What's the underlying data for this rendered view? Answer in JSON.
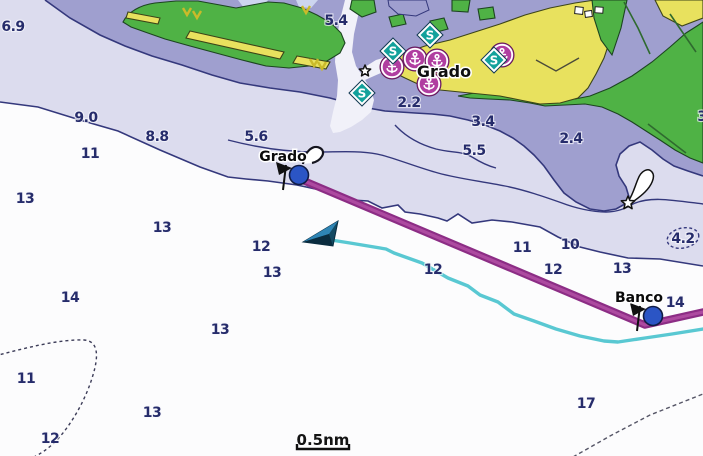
{
  "chart": {
    "type": "nautical-chartplotter-map",
    "scale_bar": {
      "label": "0.5nm",
      "x": 323,
      "y": 440,
      "bar_x1": 297,
      "bar_x2": 349,
      "bar_y": 449
    },
    "town_labels": [
      {
        "t": "Grado",
        "x": 444,
        "y": 71
      }
    ],
    "depth_labels": [
      {
        "t": "6.9",
        "x": 13,
        "y": 26
      },
      {
        "t": "5.4",
        "x": 336,
        "y": 20
      },
      {
        "t": "9.0",
        "x": 86,
        "y": 117
      },
      {
        "t": "8.8",
        "x": 157,
        "y": 136
      },
      {
        "t": "11",
        "x": 90,
        "y": 153
      },
      {
        "t": "5.6",
        "x": 256,
        "y": 136
      },
      {
        "t": "2.2",
        "x": 409,
        "y": 102
      },
      {
        "t": "3.4",
        "x": 483,
        "y": 121
      },
      {
        "t": "5.5",
        "x": 474,
        "y": 150
      },
      {
        "t": "2.4",
        "x": 571,
        "y": 138
      },
      {
        "t": "3",
        "x": 702,
        "y": 116
      },
      {
        "t": "13",
        "x": 25,
        "y": 198
      },
      {
        "t": "13",
        "x": 162,
        "y": 227
      },
      {
        "t": "12",
        "x": 261,
        "y": 246
      },
      {
        "t": "13",
        "x": 272,
        "y": 272
      },
      {
        "t": "12",
        "x": 433,
        "y": 269
      },
      {
        "t": "11",
        "x": 522,
        "y": 247
      },
      {
        "t": "10",
        "x": 570,
        "y": 244
      },
      {
        "t": "12",
        "x": 553,
        "y": 269
      },
      {
        "t": "13",
        "x": 622,
        "y": 268
      },
      {
        "t": "14",
        "x": 70,
        "y": 297
      },
      {
        "t": "13",
        "x": 220,
        "y": 329
      },
      {
        "t": "14",
        "x": 675,
        "y": 302
      },
      {
        "t": "11",
        "x": 26,
        "y": 378
      },
      {
        "t": "13",
        "x": 152,
        "y": 412
      },
      {
        "t": "12",
        "x": 50,
        "y": 438
      },
      {
        "t": "17",
        "x": 586,
        "y": 403
      }
    ],
    "circled_depth": {
      "t": "4.2",
      "x": 683,
      "y": 238
    },
    "waypoints": [
      {
        "name": "Grado",
        "x": 299,
        "y": 175,
        "label_x": 283,
        "label_y": 156
      },
      {
        "name": "Banco",
        "x": 653,
        "y": 316,
        "label_x": 639,
        "label_y": 297
      }
    ],
    "route": {
      "points": [
        [
          302,
          180
        ],
        [
          645,
          325
        ],
        [
          703,
          312
        ]
      ]
    },
    "track": {
      "points": [
        [
          331,
          240
        ],
        [
          350,
          243
        ],
        [
          386,
          249
        ],
        [
          394,
          253
        ],
        [
          422,
          263
        ],
        [
          448,
          278
        ],
        [
          468,
          286
        ],
        [
          480,
          295
        ],
        [
          498,
          302
        ],
        [
          514,
          314
        ],
        [
          534,
          321
        ],
        [
          556,
          329
        ],
        [
          580,
          336
        ],
        [
          604,
          341
        ],
        [
          618,
          342
        ],
        [
          645,
          338
        ],
        [
          672,
          334
        ],
        [
          703,
          329
        ]
      ]
    },
    "vessel": {
      "x": 303,
      "y": 242,
      "heading": "west"
    },
    "symbols": {
      "speed_restriction_signs": [
        [
          393,
          51
        ],
        [
          430,
          35
        ],
        [
          494,
          60
        ],
        [
          362,
          93
        ]
      ],
      "harbor_facilities": [
        [
          415,
          59
        ],
        [
          392,
          67
        ],
        [
          437,
          61
        ],
        [
          429,
          84
        ],
        [
          502,
          55
        ]
      ],
      "lights": [
        {
          "x": 365,
          "y": 71,
          "r": 6,
          "flare": false
        },
        {
          "x": 628,
          "y": 203,
          "r": 7,
          "flare": true
        }
      ]
    },
    "colors": {
      "deep_water": "#fcfcfd",
      "mid_water": "#dcdcee",
      "shallow_water": "#9f9fcf",
      "land": "#4fb245",
      "urban": "#e8e15e",
      "contour": "#34387c",
      "depth_text": "#262c6b",
      "route_edge": "#8c2d85",
      "route_core": "#ad4aa0",
      "track": "#59c8d2",
      "waypoint": "#2b55c5",
      "speed_sign": "#12a19b",
      "harbor": "#b03da0"
    }
  }
}
